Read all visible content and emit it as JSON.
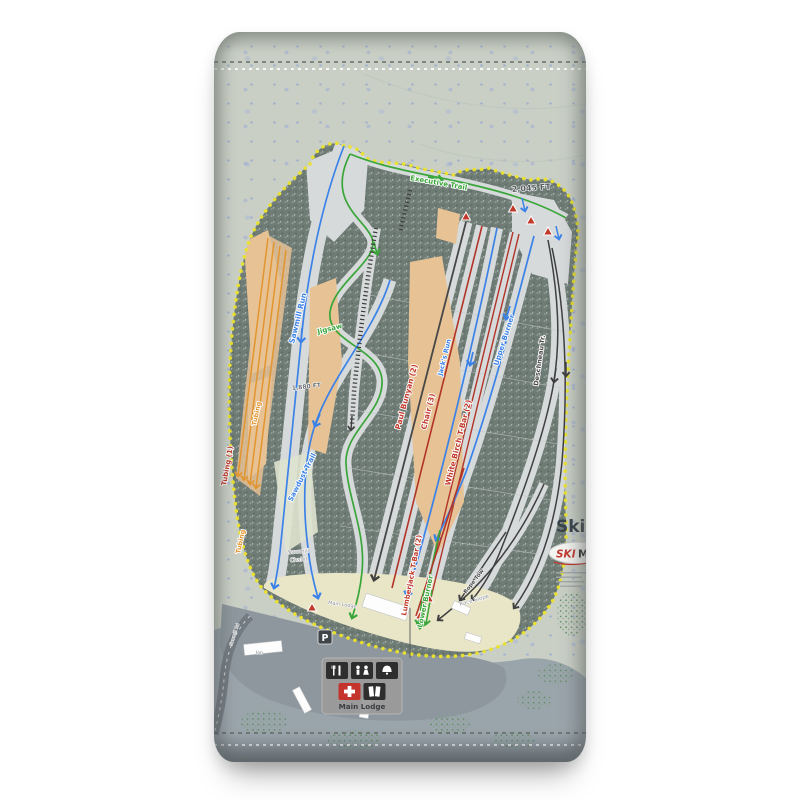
{
  "colors": {
    "fabric": "#c9cfc5",
    "fabric_bottom": "#9aa4ab",
    "boundary": "#ebe32b",
    "forest": "#6f7c76",
    "snow": "#d7dadb",
    "glade": "#e6c295",
    "base_area": "#e9e6c8",
    "easy_green": "#3aa63a",
    "intermediate_blue": "#3b82e8",
    "lift_red": "#b23328",
    "label_red": "#c0392b",
    "dark_line": "#3f3f3f",
    "tubing_orange": "#e2952f"
  },
  "elevations": {
    "summit": "2,045 FT",
    "mid": "1,880 FT"
  },
  "trails": {
    "sawmill_run": "Sawmill Run",
    "sawdust_trail": "Sawdust Trail",
    "jigsaw": "Jigsaw",
    "executive_trail": "Executive Trail",
    "jacks_run": "Jack's Run",
    "upper_burner": "Upper Burner",
    "lower_burner": "Lower Burner",
    "deschneau": "Deschneau Tr.",
    "race_slope": "Race Slope",
    "rope_tow": "Rope Tow"
  },
  "lifts": {
    "tubing": "Tubing (1)",
    "paul_bunyan": "Paul Bunyan (2)",
    "chair": "Chair (3)",
    "white_birch": "White Birch T-Bar (2)",
    "lumberjack": "Lumberjack T-Bar (2)"
  },
  "base": {
    "tubing_lane": "Tubing",
    "chalet_line1": "Sawmill",
    "chalet_line2": "Chalet",
    "lodge_building": "Main Lodge",
    "inn": "Inn",
    "road": "Sawmill Rd",
    "parking": "P",
    "lodge_panel": "Main Lodge"
  },
  "branding": {
    "big_text": "Ski",
    "logo_red": "SKI",
    "logo_dark": "M"
  }
}
